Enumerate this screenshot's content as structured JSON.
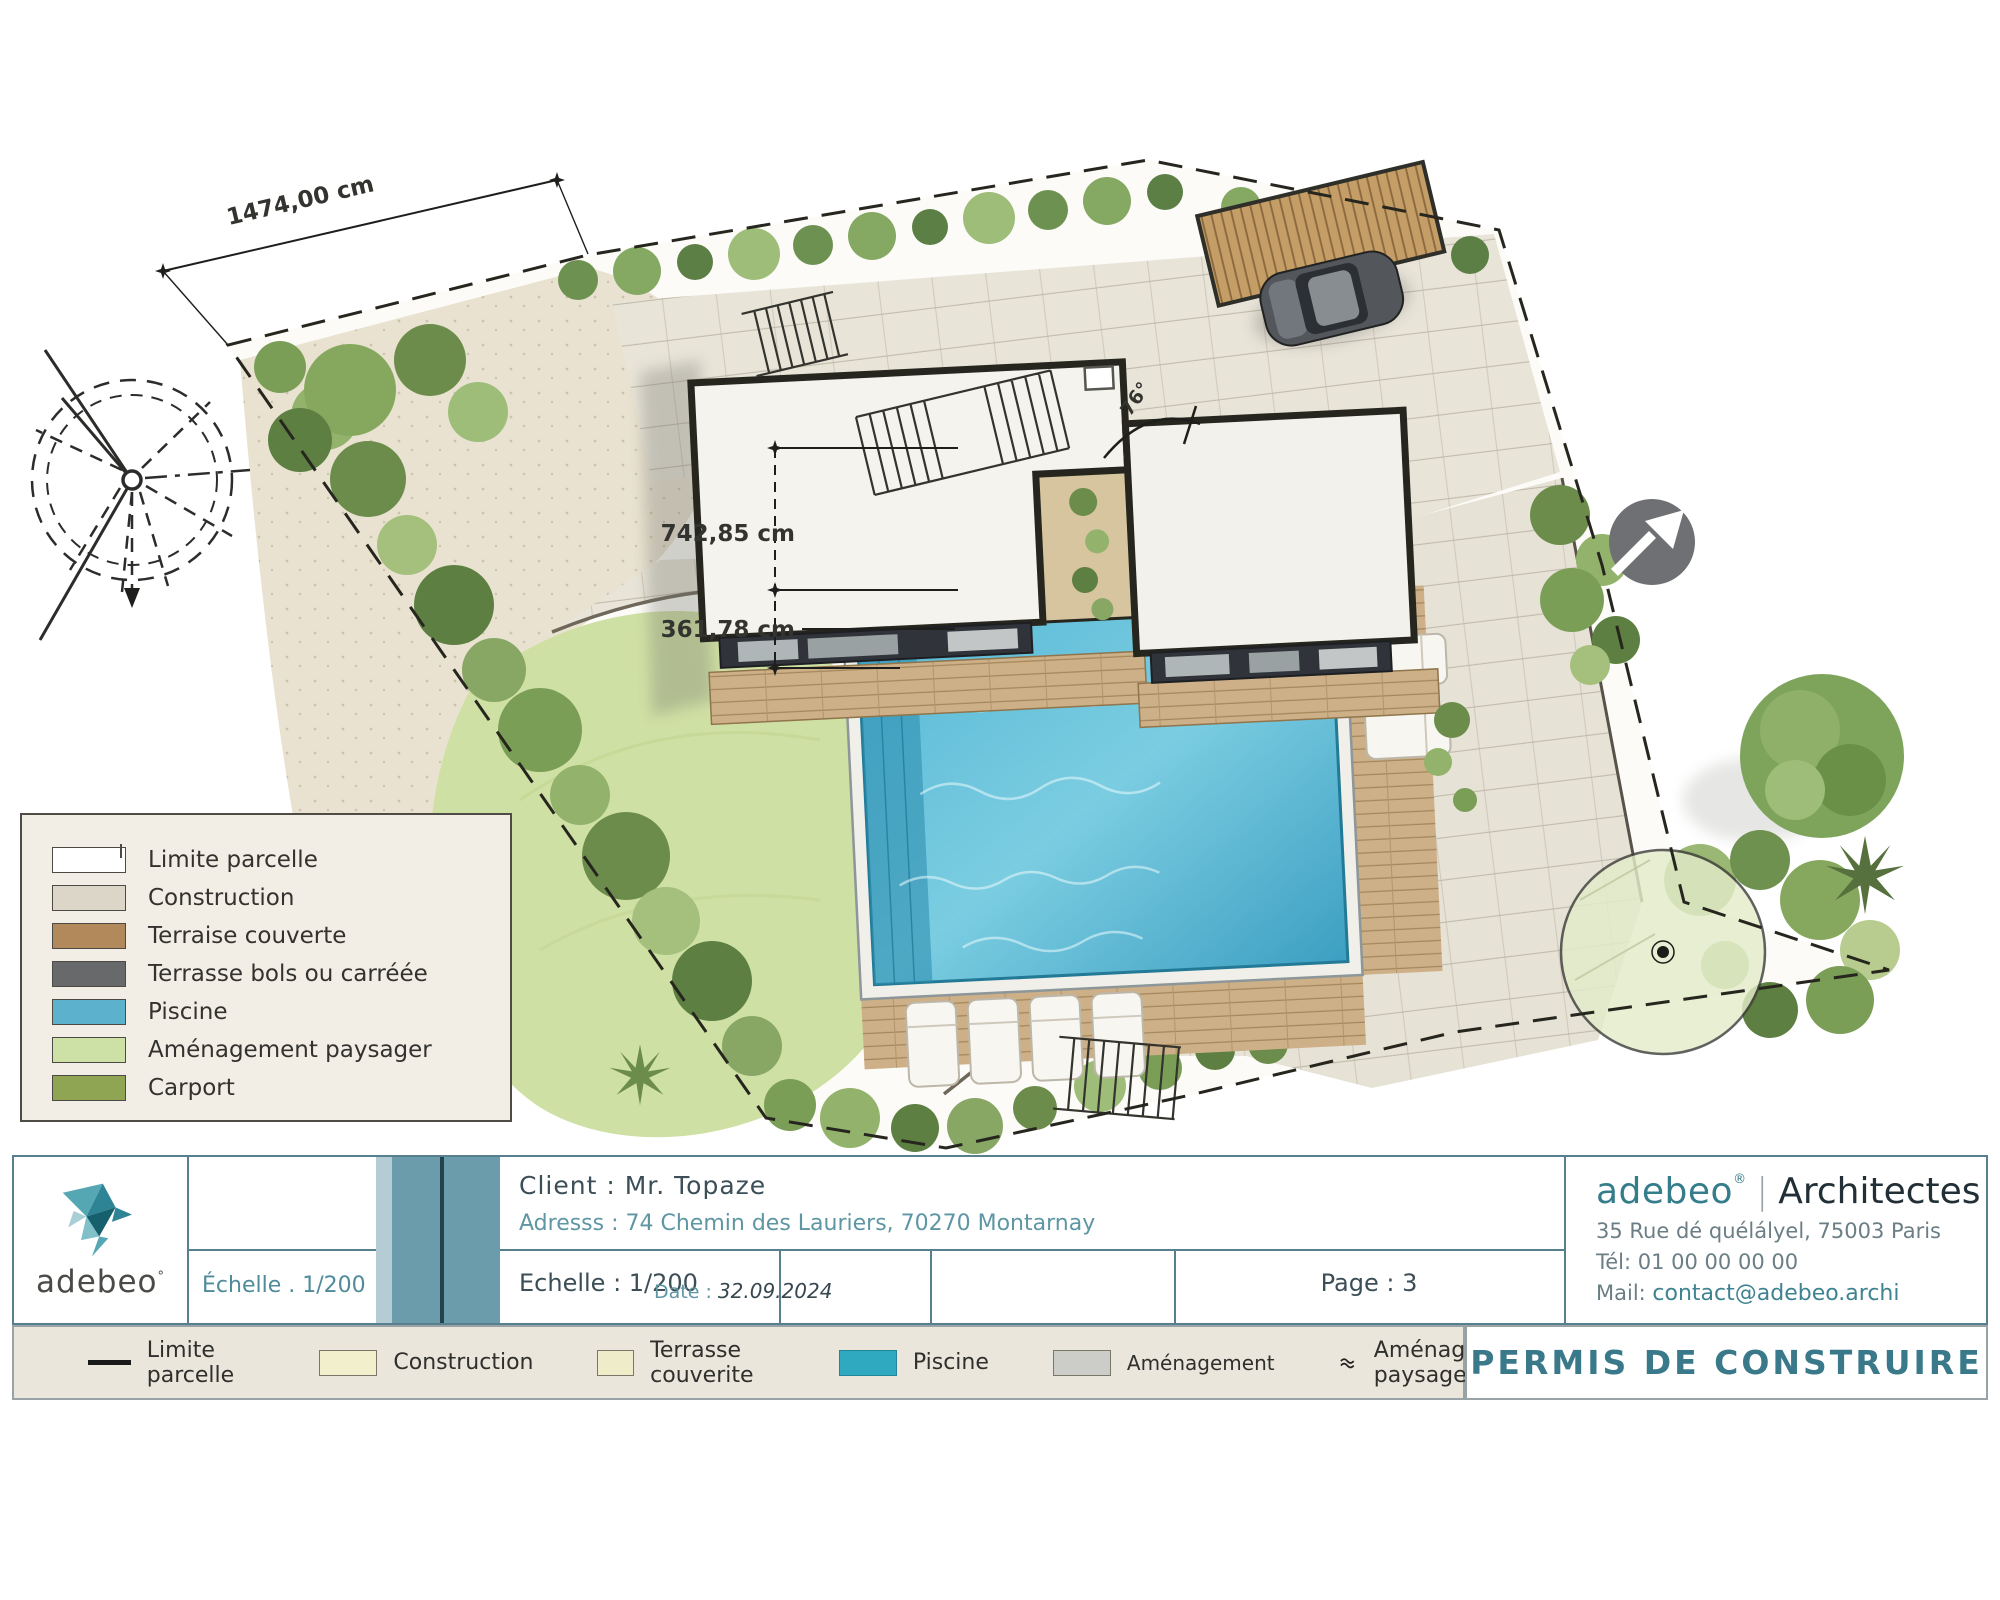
{
  "plan": {
    "dim_top": "1474,00 cm",
    "dim_height": "742,85 cm",
    "dim_offset": "361,78 cm",
    "angle_label": "76°"
  },
  "legend_box": {
    "items": [
      {
        "label": "Limite parcelle",
        "swatch": "outline",
        "color": "#ffffff"
      },
      {
        "label": "Construction",
        "swatch": "fill",
        "color": "#dcd6c8"
      },
      {
        "label": "Terraise couverte",
        "swatch": "fill",
        "color": "#b2895a"
      },
      {
        "label": "Terrasse bols ou carréée",
        "swatch": "fill",
        "color": "#67696b"
      },
      {
        "label": "Piscine",
        "swatch": "fill",
        "color": "#5cb2cc"
      },
      {
        "label": "Aménagement paysager",
        "swatch": "fill",
        "color": "#cde0a6"
      },
      {
        "label": "Carport",
        "swatch": "fill",
        "color": "#8fa554"
      }
    ]
  },
  "title_block": {
    "logo_text": "adebeo",
    "logo_mark": "°",
    "left_scale": "Échelle . 1/200",
    "client": "Client :  Mr. Topaze",
    "address": "Adresss :  74 Chemin des Lauriers, 70270 Montarnay",
    "scale": "Echelle :  1/200",
    "date_label": "Date : ",
    "date_value": "32.09.2024",
    "page": "Page :  3",
    "firm": {
      "name": "adebeo",
      "reg": "®",
      "type": "Architectes",
      "address": "35 Rue dé quélályel, 75003 Paris",
      "tel": "Tél: 01 00 00 00 00",
      "mail_label": "Mail: ",
      "mail_value": "contact@adebeo.archi"
    }
  },
  "bottom_legend": {
    "items": [
      {
        "label": "Limite parcelle",
        "swatch": "line",
        "color": "#1a1a1a"
      },
      {
        "label": "Construction",
        "swatch": "fill",
        "color": "#f2efcd"
      },
      {
        "label": "Terrasse couverite",
        "swatch": "fill",
        "color": "#efecca"
      },
      {
        "label": "Piscine",
        "swatch": "fill",
        "color": "#2fa9c0"
      },
      {
        "label": "Aménagement",
        "swatch": "fill",
        "color": "#ccccc8"
      },
      {
        "label": "Aménagement paysager",
        "swatch": "icon",
        "color": "#2a2a2a"
      }
    ],
    "permit_title": "PERMIS DE CONSTRUIRE"
  },
  "colors": {
    "accent_teal": "#3f8391",
    "slate_line": "#56808d",
    "pool_water": "#57b8d6",
    "lawn_green": "#cfe0a4",
    "gravel": "#e9e2d0"
  }
}
